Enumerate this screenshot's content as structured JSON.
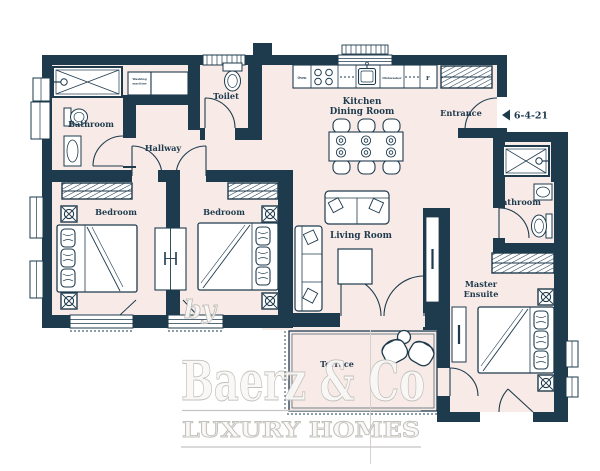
{
  "plan": {
    "type": "apartment-floor-plan",
    "reference": "6-4-21",
    "labels": {
      "bathroom_tl": "Bathroom",
      "toilet": "Toilet",
      "hallway": "Hallway",
      "kitchen_line1": "Kitchen",
      "kitchen_line2": "Dining Room",
      "entrance": "Entrance",
      "bathroom_r": "Bathroom",
      "bedroom_1": "Bedroom",
      "bedroom_2": "Bedroom",
      "living": "Living Room",
      "master_line1": "Master",
      "master_line2": "Ensuite",
      "terrace": "Terrace"
    },
    "appliances": {
      "oven": "Oven",
      "dishwasher": "Dishwasher",
      "fridge": "F",
      "washing_line1": "Washing",
      "washing_line2": "machine"
    },
    "fixtures": [
      "shower",
      "toilet",
      "sink",
      "washing-machine",
      "hob",
      "kitchen-sink",
      "fridge",
      "dining-table",
      "dining-chairs",
      "sofa",
      "chaise-sofa",
      "coffee-table",
      "bed",
      "pillows",
      "wardrobe",
      "radiator",
      "bedside-light",
      "lounge-chairs",
      "terrace-table"
    ],
    "colors": {
      "wall": "#1e3a4d",
      "floor": "#f8ebe7",
      "watermark": "#c6c4c1"
    }
  },
  "watermark": {
    "by": "by",
    "name": "Baerz & Co",
    "tagline": "LUXURY HOMES"
  }
}
